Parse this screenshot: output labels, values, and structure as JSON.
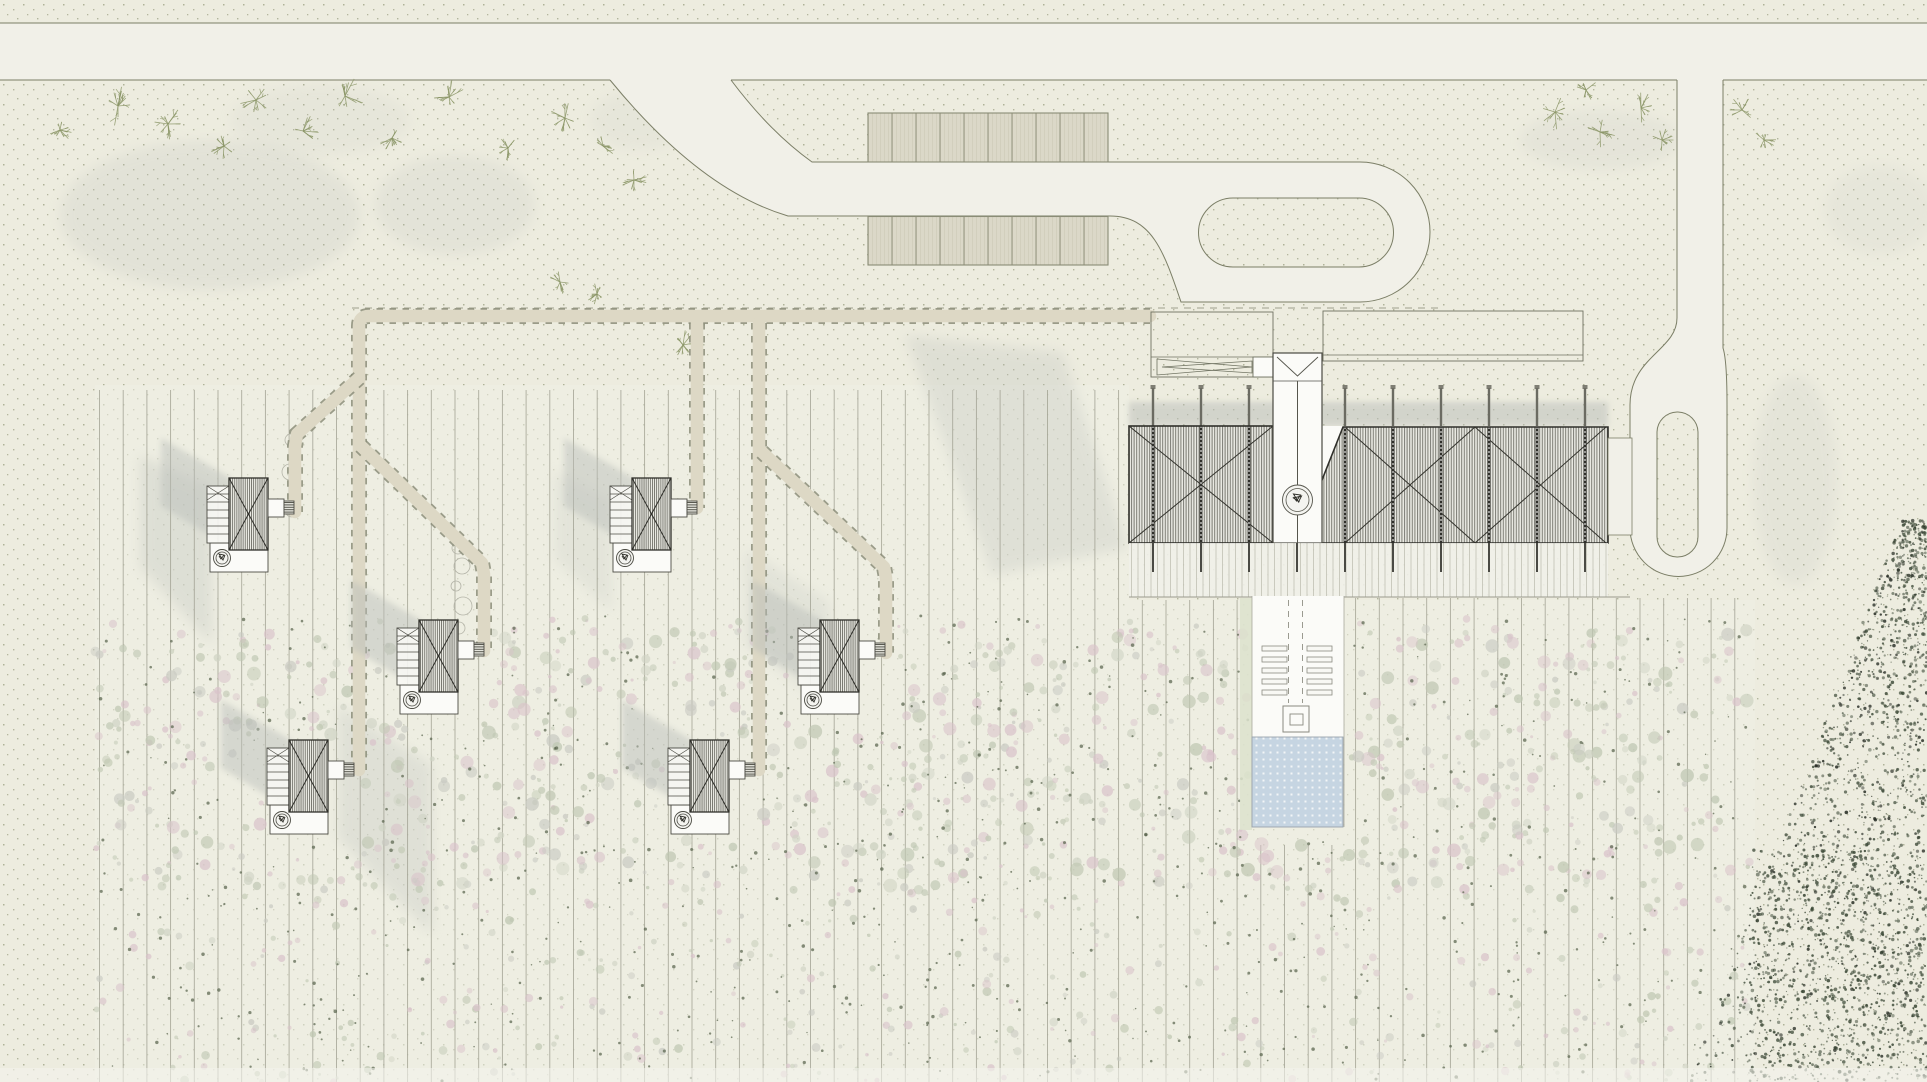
{
  "canvas": {
    "w": 1927,
    "h": 1082
  },
  "palette": {
    "ground": "#edecdf",
    "ground_dot": "#8d9372",
    "field_wash": "rgba(240,239,230,0.5)",
    "road_fill": "#f1f0e8",
    "road_line": "#7b7e66",
    "stall_fill": "#dbd8c8",
    "stall_line": "#8a8c76",
    "walk_fill": "#ddd8c5",
    "walk_dash": "#8b8d79",
    "row_line": "#a0a091",
    "ink": "#33332d",
    "cabin_line": "#4c4c44",
    "white": "#fbfbf8",
    "pool_fill": "#c6d5e2",
    "pool_line": "#9aa4ac",
    "shadow": "#b9bdb9",
    "tree": "#8a9566",
    "scatter_pink": "#d9c3ca",
    "scatter_sage": "#bfc7b2",
    "scatter_gray": "#c9cac2",
    "speck_dark": "#3d4a38"
  },
  "seed": 11,
  "roads": {
    "fills": [
      "M0,23 L1927,23 L1927,80 L0,80 Z",
      "M610,80 Q700,190 788,216 L1110,216 C1152,216 1164,252 1181,302 L1360,302 A70,70 0 0 0 1360,162 L812,162 Q770,132 731,80 Z",
      "M1677,80 L1723,80 L1723,348 C1726,357 1727,375 1727,405 L1727,528 A48.5,48.5 0 0 1 1630,528 L1630,405 C1630,357 1677,350 1677,318 Z"
    ],
    "outlines": [
      "M0,23 L1927,23",
      "M0,80 L610,80",
      "M731,80 L1677,80",
      "M1723,80 L1927,80",
      "M731,80 Q770,132 812,162 L1360,162 A70,70 0 0 1 1360,302 L1181,302 C1164,252 1152,216 1110,216 L788,216 Q700,190 610,80",
      "M1677,80 L1677,318 C1677,350 1630,357 1630,405 L1630,528 A48.5,48.5 0 0 0 1727,528 L1727,405 C1727,375 1726,357 1723,348 L1723,80"
    ],
    "islands": [
      "M1233,198 L1359,198 A34.5,34.5 0 0 1 1359,267 L1233,267 A34.5,34.5 0 0 1 1233,198 Z",
      "M1677,412 L1678,412 A20.5,20.5 0 0 1 1698,432 L1698,536 A20.5,20.5 0 0 1 1677,557 A20.5,20.5 0 0 1 1657,536 L1657,432 A20.5,20.5 0 0 1 1677,412 Z"
    ]
  },
  "parking": {
    "rows": [
      {
        "x": 868,
        "y": 113,
        "w": 240,
        "h": 49,
        "stalls": 10
      },
      {
        "x": 868,
        "y": 216.5,
        "w": 240,
        "h": 48.5,
        "stalls": 10
      }
    ]
  },
  "walks": {
    "lines": [
      "M1150,316 L369,316 Q359,316 359,326 L359,770",
      "M359,378 L297,434 L295,446 L295,512",
      "M361,446 L482,563 L484,574 L484,651",
      "M697,323 L697,508",
      "M759,323 L759,770",
      "M762,452 L884,567 L886,578 L886,653"
    ],
    "dash_line": "M352,308 L1438,308"
  },
  "rows_cfg": {
    "x0": 99.5,
    "step": 23.7,
    "x_max": 1752,
    "y_end": 1082,
    "zones": [
      {
        "x_lt": 1129,
        "y1": 390
      },
      {
        "x_lt": 1253,
        "y1": 600
      },
      {
        "x_lt": 1343,
        "y1": 845
      },
      {
        "x_lt": 1753,
        "y1": 598
      }
    ]
  },
  "building": {
    "shadow_band": {
      "x": 1129,
      "y": 402,
      "w": 479,
      "h": 24
    },
    "swaths": [
      {
        "pts": "905,335 1063,352 1128,548 992,575",
        "op": 0.27
      },
      {
        "pts": "140,455 212,487 212,645 140,567",
        "op": 0.3
      },
      {
        "pts": "338,705 432,765 432,935 338,838",
        "op": 0.28
      },
      {
        "pts": "555,470 612,500 612,612 555,560",
        "op": 0.2
      },
      {
        "pts": "745,548 830,602 830,708 745,645",
        "op": 0.22
      }
    ],
    "posts_x": [
      1153,
      1201,
      1249,
      1297,
      1345,
      1393,
      1441,
      1489,
      1537,
      1585
    ],
    "roof_left": {
      "x": 1129,
      "y": 426,
      "w": 144,
      "h": 117
    },
    "roof_right_pts": "1343,427 1608,427 1608,543 1297,543",
    "gap_pts": "1273,426 1343,426 1297,543 1273,543",
    "battens_left": [
      1153,
      1201,
      1249
    ],
    "battens_right": [
      1345,
      1393,
      1441,
      1489,
      1537,
      1585
    ],
    "tower": {
      "x": 1273,
      "y": 353,
      "w": 49,
      "h": 190
    },
    "stair": {
      "cx": 1297.5,
      "cy": 500,
      "r1": 15,
      "r2": 11.5
    },
    "forecourt": {
      "x": 1151,
      "y": 312,
      "w": 122,
      "h": 65
    },
    "small_sq": {
      "x": 1253,
      "y": 357,
      "w": 20,
      "h": 20
    },
    "canopy": {
      "x": 1323,
      "y": 311,
      "w": 260,
      "h": 50
    },
    "terrace": {
      "x": 1129,
      "y": 543,
      "w": 479,
      "h": 54
    },
    "connector": {
      "x": 1608,
      "y": 438,
      "w": 24,
      "h": 97
    }
  },
  "corridor": {
    "slab": {
      "x": 1252,
      "y": 596,
      "w": 92,
      "h": 142
    },
    "green_strip": {
      "x": 1240,
      "y": 598,
      "w": 12,
      "h": 232
    },
    "dash_x": [
      1288.5,
      1302.5
    ],
    "dash_y": [
      600,
      703
    ],
    "bench_cols": [
      1262,
      1307
    ],
    "bench_rows": [
      646,
      657,
      668,
      679,
      690
    ],
    "bench_w": 25,
    "bench_h": 5,
    "spa": {
      "x": 1283,
      "y": 706,
      "w": 26,
      "h": 26
    },
    "spa_inner": {
      "x": 1290,
      "y": 714,
      "w": 13,
      "h": 11
    }
  },
  "pool": {
    "x": 1252,
    "y": 737,
    "w": 91,
    "h": 90
  },
  "cabins": {
    "positions": [
      [
        207,
        478
      ],
      [
        610,
        478
      ],
      [
        397,
        620
      ],
      [
        798,
        620
      ],
      [
        267,
        740
      ],
      [
        668,
        740
      ]
    ],
    "shadow_pts": "-46,-40 24,0 24,70 -46,28",
    "deck": {
      "x": 0,
      "y": 8,
      "w": 22,
      "h": 57
    },
    "roof": {
      "x": 22,
      "y": 0,
      "w": 39,
      "h": 72
    },
    "annex": {
      "x": 61,
      "y": 21,
      "w": 16,
      "h": 18
    },
    "porch": {
      "x": 77,
      "y": 23,
      "w": 10,
      "h": 13
    },
    "terrace": {
      "x": 3,
      "y": 65,
      "w": 58,
      "h": 29
    },
    "tub": {
      "cx": 15,
      "cy": 80,
      "r1": 8.5,
      "r2": 6
    }
  },
  "trees": [
    [
      118,
      106,
      20
    ],
    [
      168,
      124,
      16
    ],
    [
      224,
      146,
      13
    ],
    [
      256,
      100,
      17
    ],
    [
      303,
      131,
      15
    ],
    [
      345,
      96,
      18
    ],
    [
      392,
      138,
      13
    ],
    [
      449,
      97,
      16
    ],
    [
      508,
      148,
      12
    ],
    [
      60,
      130,
      11
    ],
    [
      565,
      118,
      15
    ],
    [
      603,
      146,
      13
    ],
    [
      634,
      180,
      12
    ],
    [
      560,
      282,
      12
    ],
    [
      597,
      294,
      10
    ],
    [
      683,
      345,
      14
    ],
    [
      1555,
      112,
      17
    ],
    [
      1600,
      132,
      15
    ],
    [
      1641,
      108,
      14
    ],
    [
      1662,
      140,
      11
    ],
    [
      1586,
      90,
      11
    ],
    [
      1742,
      110,
      13
    ],
    [
      1764,
      140,
      11
    ]
  ],
  "washes": [
    [
      210,
      215,
      150,
      75,
      0.2
    ],
    [
      455,
      205,
      80,
      50,
      0.18
    ],
    [
      320,
      120,
      90,
      35,
      0.12
    ],
    [
      1600,
      140,
      80,
      30,
      0.15
    ],
    [
      1795,
      480,
      42,
      105,
      0.16
    ],
    [
      1880,
      210,
      55,
      45,
      0.12
    ],
    [
      640,
      120,
      50,
      30,
      0.12
    ]
  ],
  "bubbles": [
    [
      291,
      440,
      6
    ],
    [
      294,
      456,
      4
    ],
    [
      290,
      472,
      8
    ],
    [
      295,
      492,
      5
    ],
    [
      292,
      510,
      7
    ],
    [
      458,
      548,
      6
    ],
    [
      462,
      566,
      8
    ],
    [
      456,
      586,
      5
    ],
    [
      463,
      606,
      9
    ],
    [
      459,
      628,
      6
    ],
    [
      466,
      648,
      4
    ]
  ],
  "field_washes": [
    [
      95,
      385,
      1034,
      697
    ],
    [
      1129,
      600,
      626,
      482
    ]
  ],
  "scatter": {
    "regions": [
      {
        "x": 95,
        "y": 618,
        "w": 1655,
        "h": 464,
        "n": 850,
        "rmin": 1.5,
        "rmax": 4.5
      },
      {
        "x": 95,
        "y": 630,
        "w": 1655,
        "h": 260,
        "n": 650,
        "rmin": 2.5,
        "rmax": 7
      }
    ],
    "dark_dots": {
      "x": 95,
      "y": 615,
      "w": 1655,
      "h": 467,
      "n": 750
    },
    "exclusions": [
      [
        1248,
        593,
        100,
        240
      ],
      [
        1125,
        400,
        487,
        200
      ],
      [
        202,
        473,
        100,
        105
      ],
      [
        605,
        473,
        100,
        105
      ],
      [
        392,
        615,
        100,
        105
      ],
      [
        793,
        615,
        100,
        105
      ],
      [
        262,
        735,
        100,
        105
      ],
      [
        663,
        735,
        100,
        105
      ]
    ]
  },
  "corner_stipple": {
    "n_wedge": 1500,
    "n_dense": 700
  },
  "bottom_band": {
    "x": 0,
    "y": 1068,
    "w": 1927,
    "h": 14
  }
}
